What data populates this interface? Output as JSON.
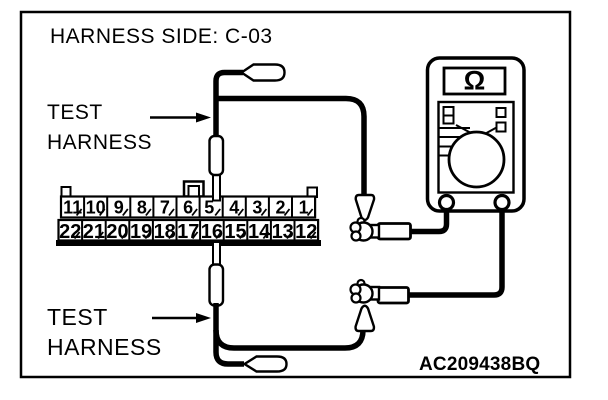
{
  "figure": {
    "title": "HARNESS SIDE: C-03",
    "code": "AC209438BQ",
    "labels": {
      "test_top": {
        "line1": "TEST",
        "line2": "HARNESS"
      },
      "test_bottom": {
        "line1": "TEST",
        "line2": "HARNESS"
      }
    },
    "meter": {
      "mode_symbol": "Ω"
    },
    "connector": {
      "top_row": [
        "11",
        "10",
        "9",
        "8",
        "7",
        "6",
        "5",
        "4",
        "3",
        "2",
        "1"
      ],
      "bottom_row": [
        "22",
        "21",
        "20",
        "19",
        "18",
        "17",
        "16",
        "15",
        "14",
        "13",
        "12"
      ]
    },
    "colors": {
      "ink": "#000000",
      "background": "#ffffff"
    }
  }
}
